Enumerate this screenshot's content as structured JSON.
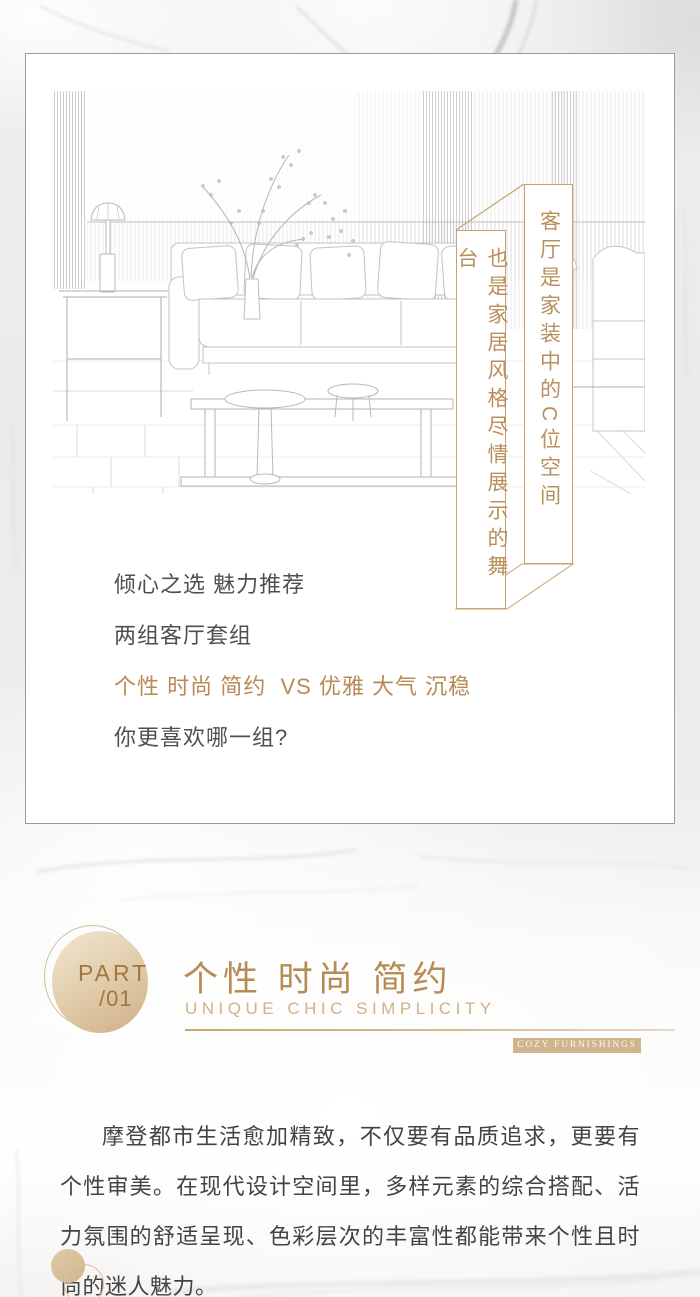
{
  "banners": {
    "right_text": "客厅是家装中的C位空间",
    "left_text": "也是家居风格尽情展示的舞台"
  },
  "intro": {
    "line1": "倾心之选 魅力推荐",
    "line2": "两组客厅套组",
    "line3": "个性 时尚 简约  VS 优雅 大气 沉稳",
    "line4": "你更喜欢哪一组?"
  },
  "section": {
    "part_label": "PART",
    "part_slash": "/",
    "part_number": "01",
    "title": "个性 时尚 简约",
    "subtitle": "UNIQUE CHIC SIMPLICITY",
    "tag": "COZY FURNISHINGS"
  },
  "body_paragraph": "摩登都市生活愈加精致，不仅要有品质追求，更要有个性审美。在现代设计空间里，多样元素的综合搭配、活力氛围的舒适呈现、色彩层次的丰富性都能带来个性且时尚的迷人魅力。",
  "colors": {
    "gold": "#b68b55",
    "gold_light": "#cfb28b",
    "banner_border": "#c9a272",
    "banner_text": "#b9905c",
    "badge_bg": "#cfb48c",
    "text_dark": "#434343"
  }
}
